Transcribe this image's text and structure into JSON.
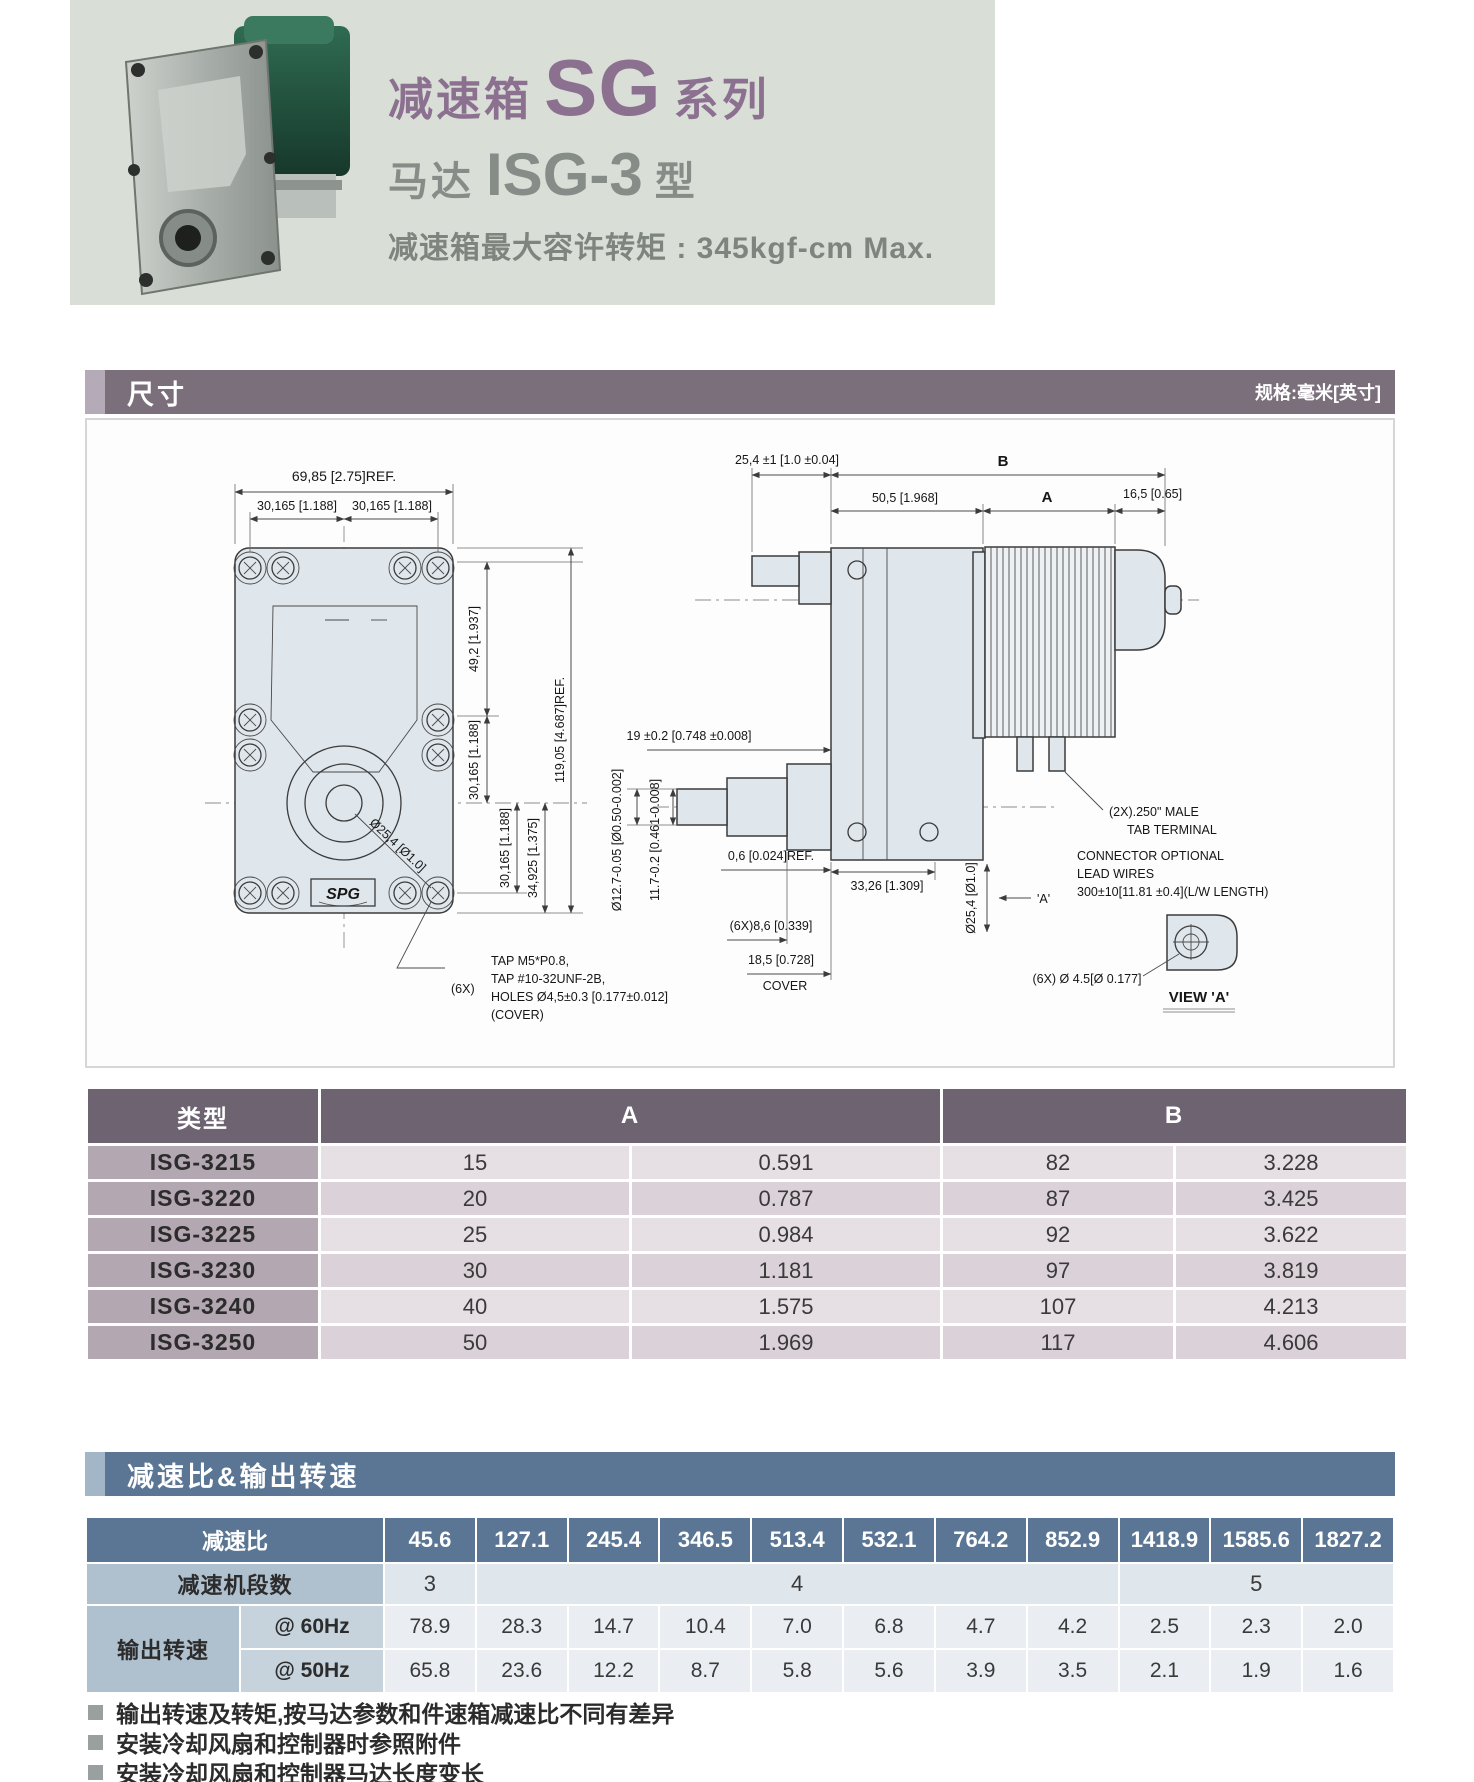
{
  "header": {
    "series_prefix": "减速箱",
    "series_big": "SG",
    "series_suffix": "系列",
    "model_prefix": "马达",
    "model_big": "ISG-3",
    "model_suffix": "型",
    "torque_line": "减速箱最大容许转矩 : 345kgf-cm Max."
  },
  "dimensions_section": {
    "title": "尺寸",
    "unit_note": "规格:毫米[英寸]"
  },
  "drawing": {
    "logo": "SPG",
    "labels": {
      "front_width": "69,85 [2.75]REF.",
      "front_hole_left": "30,165 [1.188]",
      "front_hole_right": "30,165 [1.188]",
      "front_v1": "49,2 [1.937]",
      "front_v2": "30,165 [1.188]",
      "front_v3": "30,165 [1.188]",
      "front_v4": "34,925 [1.375]",
      "front_height": "119,05 [4.687]REF.",
      "front_shaft": "Ø25,4 [Ø1.0]",
      "tap_qty": "(6X)",
      "tap_1": "TAP M5*P0.8,",
      "tap_2": "TAP #10-32UNF-2B,",
      "tap_3": "HOLES Ø4,5±0.3 [0.177±0.012]",
      "tap_4": "(COVER)",
      "side_shaft_len": "25,4 ±1 [1.0 ±0.04]",
      "dim_b": "B",
      "side_gear_len": "50,5 [1.968]",
      "dim_a": "A",
      "side_fan_len": "16,5 [0.65]",
      "side_19": "19 ±0.2 [0.748 ±0.008]",
      "side_06": "0,6 [0.024]REF.",
      "side_d127": "Ø12.7-0.05 [Ø0.50-0.002]",
      "side_117": "11.7-0.2 [0.461-0.008]",
      "side_86": "(6X)8,6 [0.339]",
      "side_185": "18,5 [0.728]",
      "side_cover": "COVER",
      "side_3326": "33,26 [1.309]",
      "side_d254": "Ø25,4 [Ø1.0]",
      "side_a_ref": "'A'",
      "tab_1": "(2X).250\" MALE",
      "tab_2": "TAB TERMINAL",
      "conn_1": "CONNECTOR OPTIONAL",
      "conn_2": "LEAD WIRES",
      "conn_3": "300±10[11.81 ±0.4](L/W LENGTH)",
      "view_a_hole": "(6X) Ø 4.5[Ø 0.177]",
      "view_a": "VIEW 'A'"
    }
  },
  "size_table": {
    "col_type": "类型",
    "col_a": "A",
    "col_b": "B",
    "rows": [
      {
        "type": "ISG-3215",
        "a_mm": "15",
        "a_in": "0.591",
        "b_mm": "82",
        "b_in": "3.228"
      },
      {
        "type": "ISG-3220",
        "a_mm": "20",
        "a_in": "0.787",
        "b_mm": "87",
        "b_in": "3.425"
      },
      {
        "type": "ISG-3225",
        "a_mm": "25",
        "a_in": "0.984",
        "b_mm": "92",
        "b_in": "3.622"
      },
      {
        "type": "ISG-3230",
        "a_mm": "30",
        "a_in": "1.181",
        "b_mm": "97",
        "b_in": "3.819"
      },
      {
        "type": "ISG-3240",
        "a_mm": "40",
        "a_in": "1.575",
        "b_mm": "107",
        "b_in": "4.213"
      },
      {
        "type": "ISG-3250",
        "a_mm": "50",
        "a_in": "1.969",
        "b_mm": "117",
        "b_in": "4.606"
      }
    ]
  },
  "ratio_section": {
    "title": "减速比&输出转速"
  },
  "ratio_table": {
    "ratio_label": "减速比",
    "ratios": [
      "45.6",
      "127.1",
      "245.4",
      "346.5",
      "513.4",
      "532.1",
      "764.2",
      "852.9",
      "1418.9",
      "1585.6",
      "1827.2"
    ],
    "stages_label": "减速机段数",
    "stages": [
      {
        "value": "3"
      },
      {
        "value": "4"
      },
      {
        "value": "5"
      }
    ],
    "output_label": "输出转速",
    "rows": [
      {
        "freq": "@ 60Hz",
        "values": [
          "78.9",
          "28.3",
          "14.7",
          "10.4",
          "7.0",
          "6.8",
          "4.7",
          "4.2",
          "2.5",
          "2.3",
          "2.0"
        ]
      },
      {
        "freq": "@ 50Hz",
        "values": [
          "65.8",
          "23.6",
          "12.2",
          "8.7",
          "5.8",
          "5.6",
          "3.9",
          "3.5",
          "2.1",
          "1.9",
          "1.6"
        ]
      }
    ]
  },
  "notes": [
    "输出转速及转矩,按马达参数和件速箱减速比不同有差异",
    "安装冷却风扇和控制器时参照附件",
    "安装冷却风扇和控制器马达长度变长"
  ],
  "colors": {
    "accent_purple": "#7b6f7c",
    "accent_blue": "#5a7694",
    "title_purple": "#8c7090"
  }
}
